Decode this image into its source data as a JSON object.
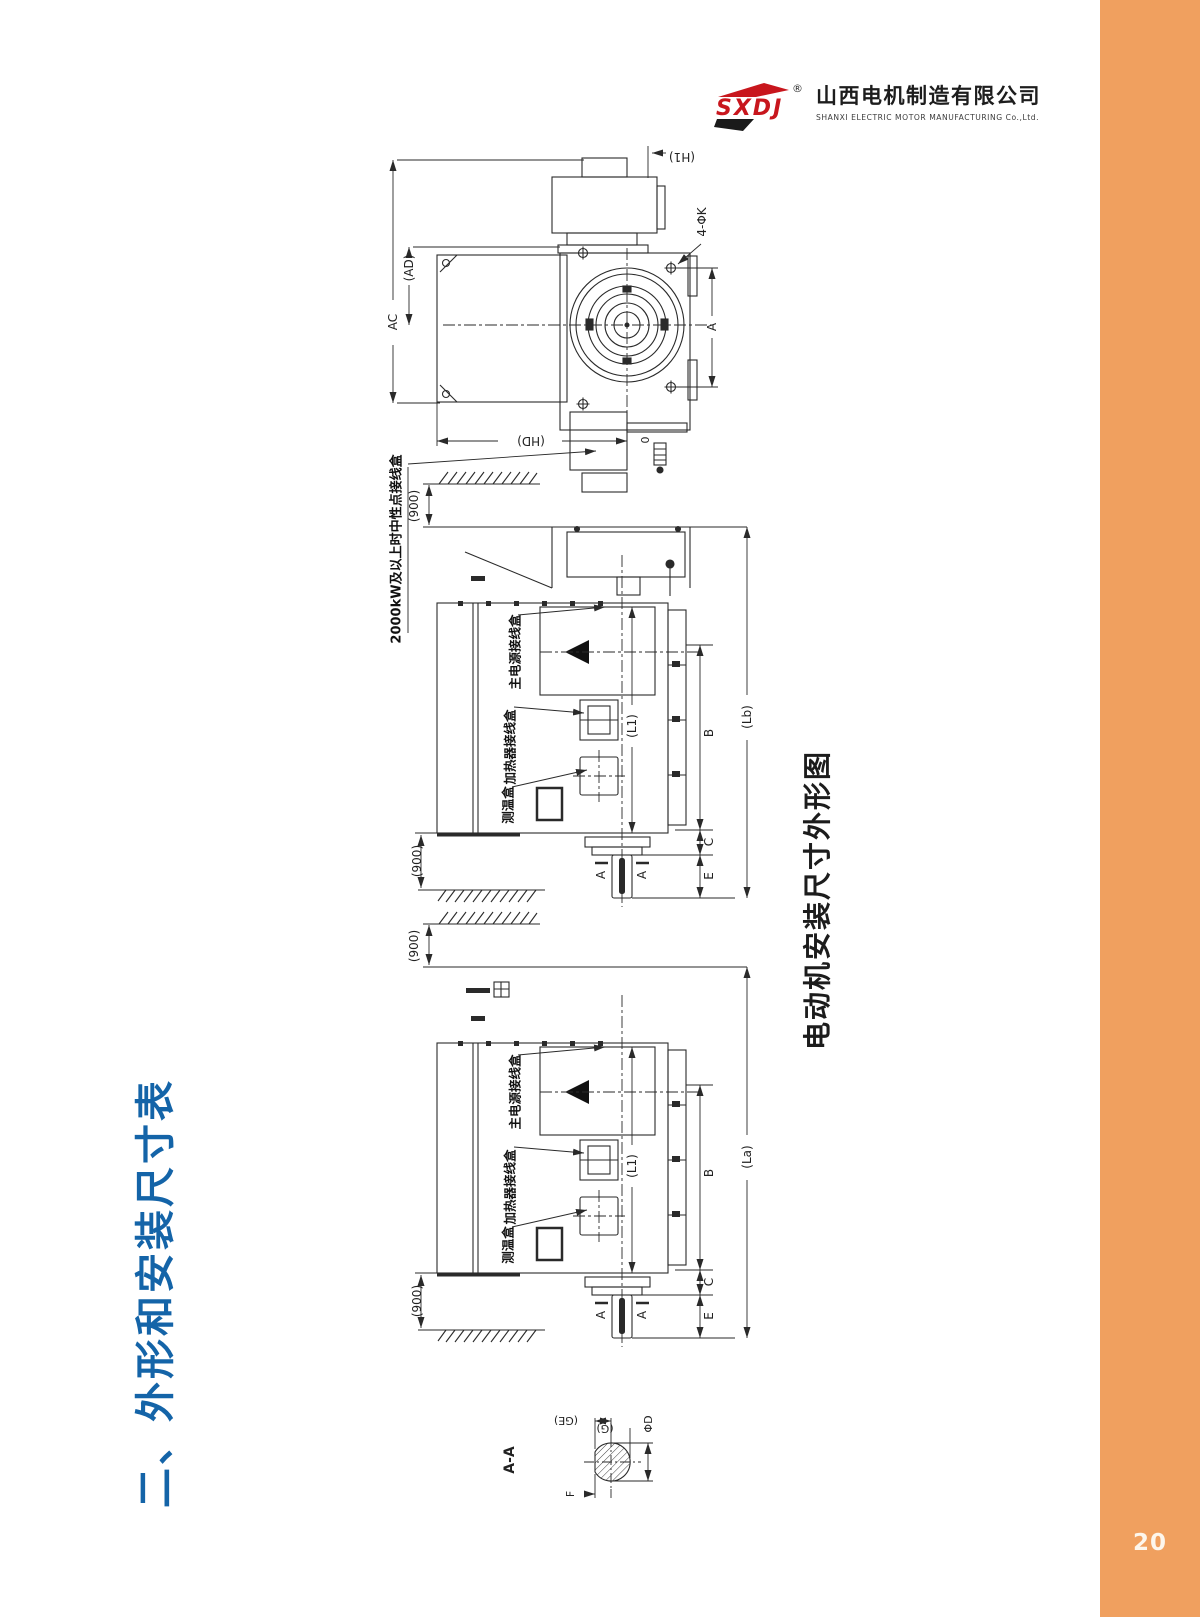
{
  "page": {
    "number": "20"
  },
  "logo": {
    "mark": "SXDJ",
    "registered": "®",
    "company_cn": "山西电机制造有限公司",
    "company_en": "SHANXI ELECTRIC MOTOR MANUFACTURING Co.,Ltd."
  },
  "titles": {
    "section": "二、外形和安装尺寸表",
    "figure": "电动机安装尺寸外形图"
  },
  "colors": {
    "accent_orange": "#F0A05F",
    "title_blue": "#1464A8",
    "logo_red": "#C8161D",
    "line": "#2a2a2a"
  },
  "end_view": {
    "ac": "AC",
    "ad": "(AD)",
    "h1": "(H1)",
    "bolt_holes": "4-ΦK",
    "a": "A",
    "hd": "(HD)",
    "zero": "0"
  },
  "side_view": {
    "clearance": "(900)",
    "note_neutral_box": "2000kW及以上时中性点接线盒",
    "main_terminal_box": "主电源接线盒",
    "heater_terminal_box": "加热器接线盒",
    "temperature_box": "测温盒",
    "l1": "(L1)",
    "b": "B",
    "c": "C",
    "e": "E",
    "lb": "(Lb)",
    "la": "(La)",
    "section_mark": "A"
  },
  "section_view": {
    "title": "A-A",
    "ge": "(GE)",
    "g": "(G)",
    "phi_d": "ΦD",
    "f": "F"
  }
}
